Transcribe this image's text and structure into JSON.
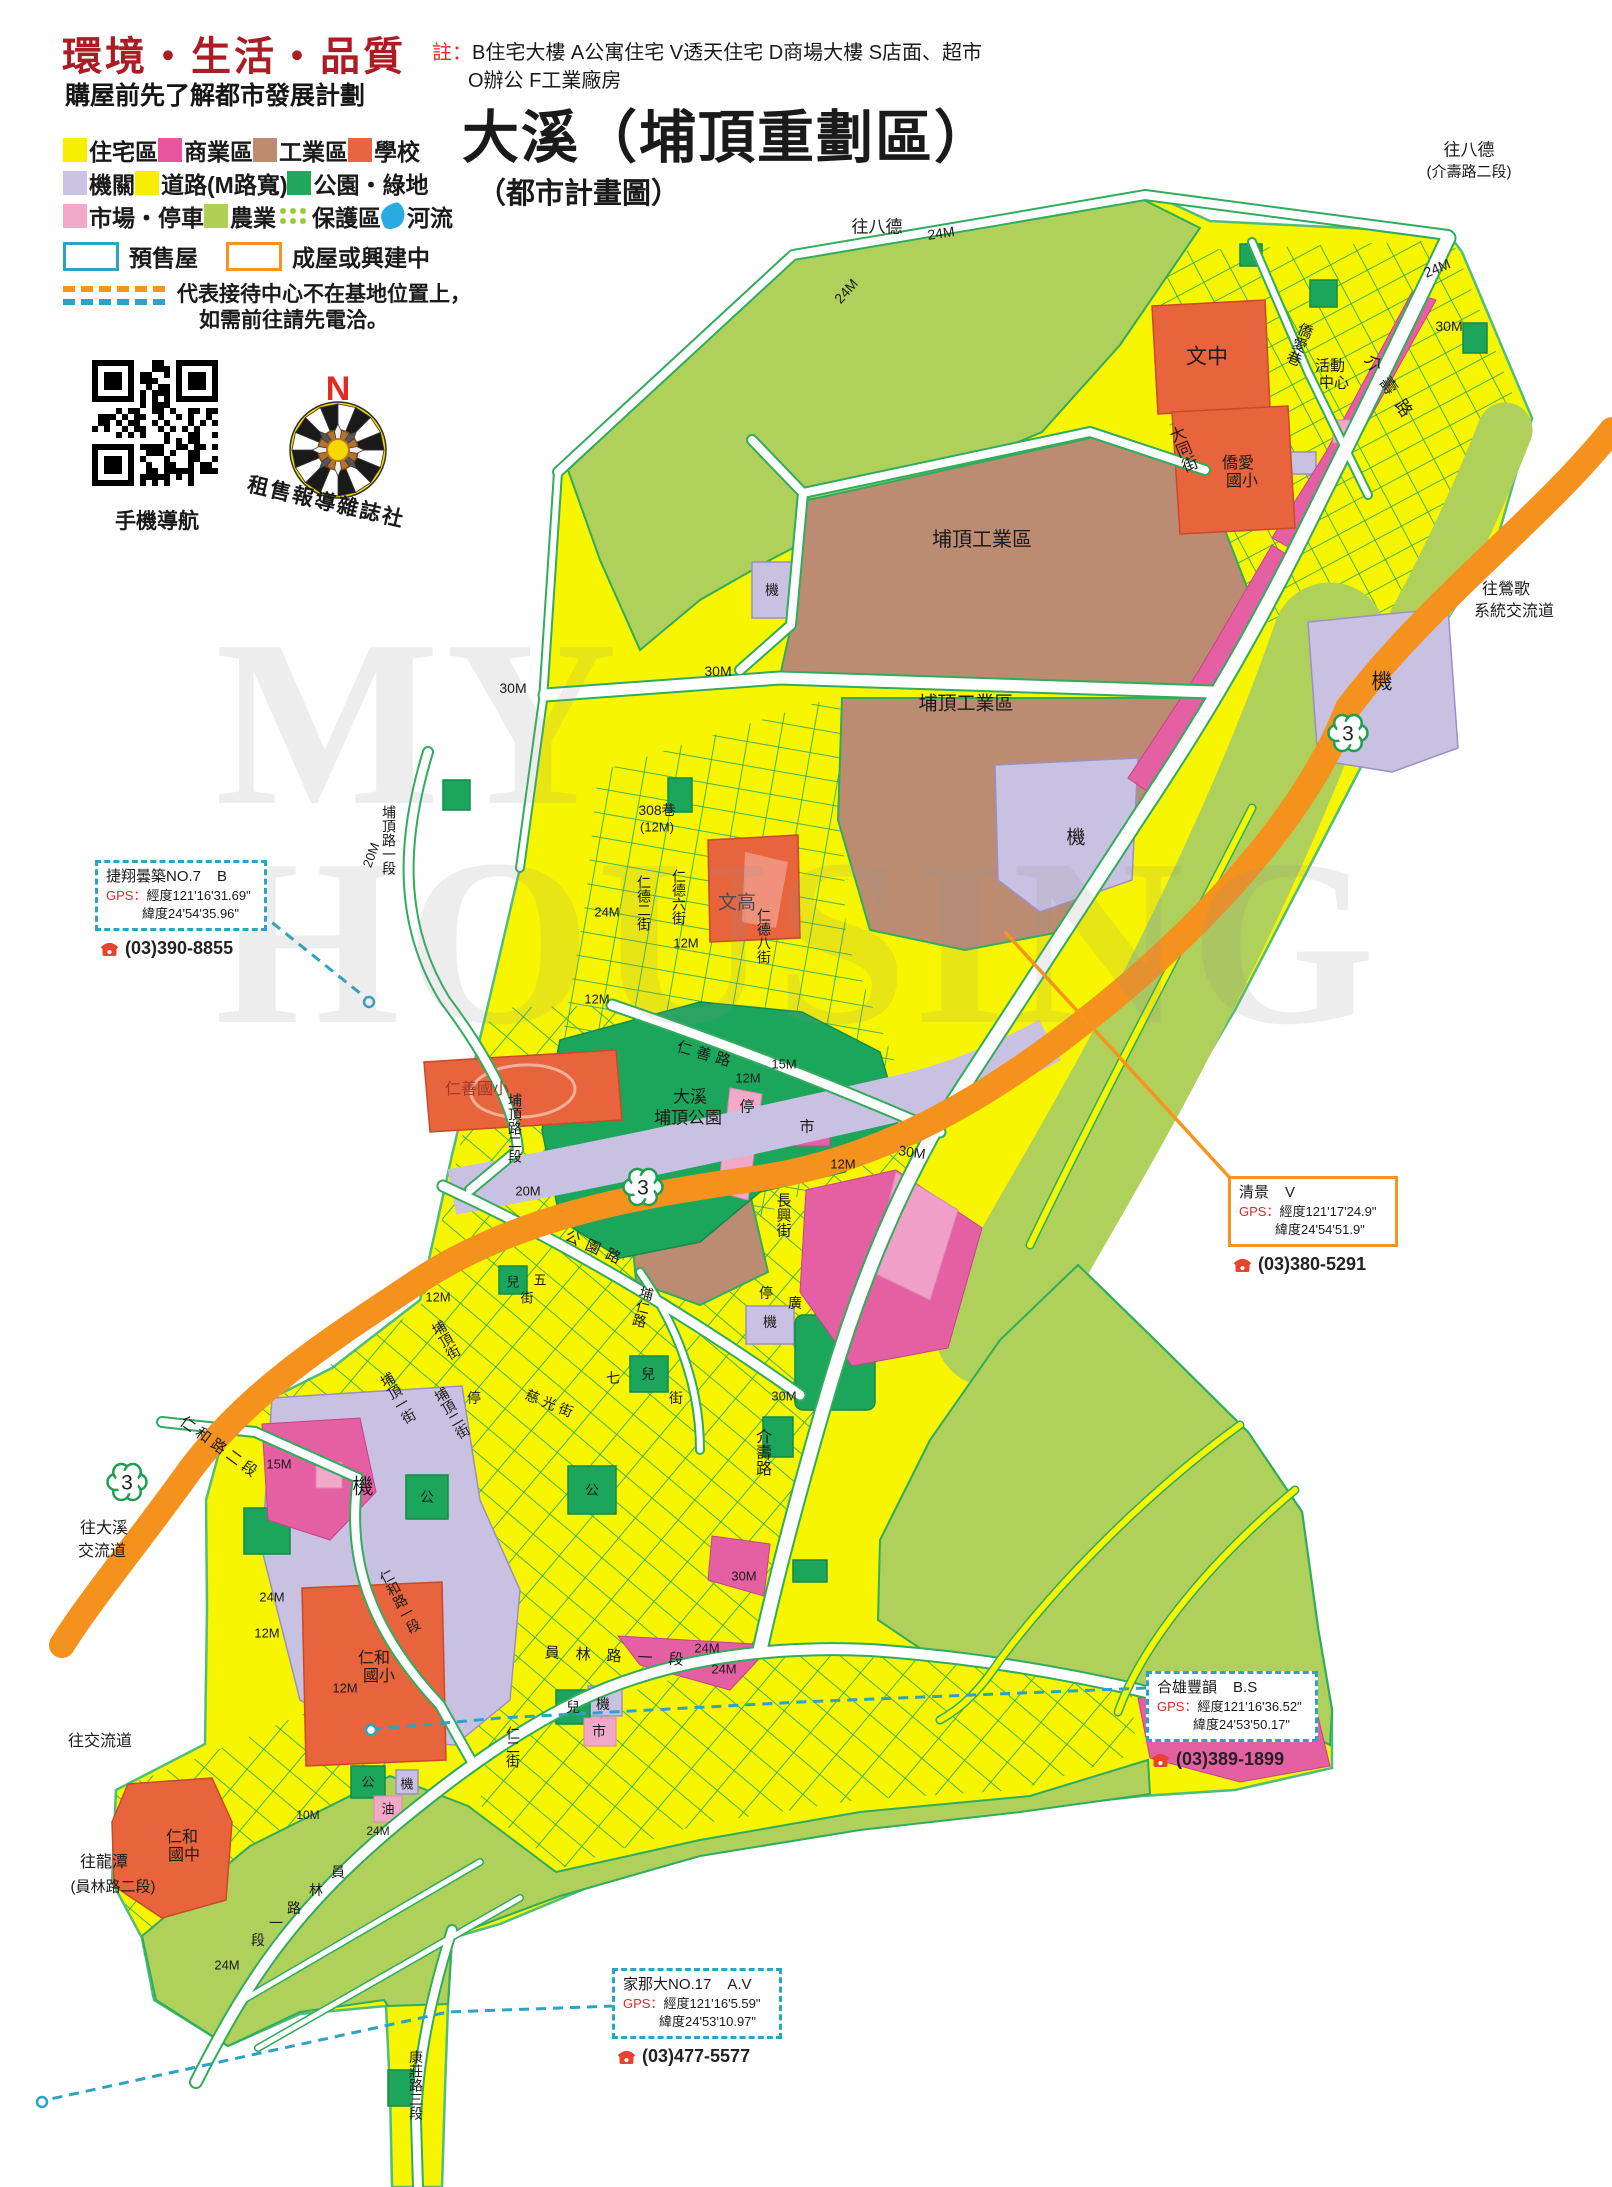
{
  "header": {
    "slogan": "環境・生活・品質",
    "subtitle": "購屋前先了解都市發展計劃",
    "note_label": "註：",
    "note_line1": "B住宅大樓 A公寓住宅 V透天住宅 D商場大樓 S店面、超市",
    "note_line2": "O辦公 F工業廠房",
    "title": "大溪（埔頂重劃區）",
    "title2": "（都市計畫圖）"
  },
  "legend": {
    "rows": [
      [
        {
          "label": "住宅區",
          "swatch": "yellow"
        },
        {
          "label": "商業區",
          "swatch": "magenta"
        },
        {
          "label": "工業區",
          "swatch": "brown"
        },
        {
          "label": "學校",
          "swatch": "orange"
        }
      ],
      [
        {
          "label": "機關",
          "swatch": "lavender"
        },
        {
          "label": "道路(M路寬)",
          "swatch": "yellow"
        },
        {
          "label": "公園・綠地",
          "swatch": "green"
        }
      ],
      [
        {
          "label": "市場・停車",
          "swatch": "lightpink"
        },
        {
          "label": "農業",
          "swatch": "lightgreen"
        },
        {
          "label": "保護區",
          "swatch": "dots"
        },
        {
          "label": "河流",
          "swatch": "river"
        }
      ]
    ],
    "presale": "預售屋",
    "built": "成屋或興建中",
    "dash_note1": "代表接待中心不在基地位置上，",
    "dash_note2": "如需前往請先電洽。"
  },
  "qr": {
    "caption": "手機導航"
  },
  "compass": {
    "north": "N",
    "brand": "租售報導雜誌社"
  },
  "watermark": {
    "line1": "MY",
    "line2": "HOUSING"
  },
  "colors": {
    "residential": "#F7F500",
    "commercial": "#E560A2",
    "industrial": "#BC8C72",
    "school": "#E8643C",
    "institution": "#C9C1E2",
    "park": "#1CA65C",
    "market": "#F2A9C9",
    "agriculture": "#AFD05A",
    "river": "#29ABE2",
    "presale_border": "#2AA3C6",
    "built_border": "#F7941E",
    "highway": "#F5921E",
    "road_outline": "#2FAC5C"
  },
  "route_markers": {
    "label": "3",
    "points": [
      {
        "x": 1348,
        "y": 733
      },
      {
        "x": 643,
        "y": 1187
      },
      {
        "x": 127,
        "y": 1482
      }
    ]
  },
  "callouts": [
    {
      "name": "捷翔曇築NO.7",
      "type": "B",
      "gps_label": "GPS：",
      "gps_lng": "經度121'16'31.69\"",
      "gps_lat": "緯度24'54'35.96\"",
      "phone": "(03)390-8855",
      "style": "dashed",
      "x": 95,
      "y": 860,
      "w": 150
    },
    {
      "name": "清景",
      "type": "V",
      "gps_label": "GPS：",
      "gps_lng": "經度121'17'24.9\"",
      "gps_lat": "緯度24'54'51.9\"",
      "phone": "(03)380-5291",
      "style": "solid",
      "x": 1228,
      "y": 1176,
      "w": 148
    },
    {
      "name": "合雄豐韻",
      "type": "B.S",
      "gps_label": "GPS：",
      "gps_lng": "經度121'16'36.52\"",
      "gps_lat": "緯度24'53'50.17\"",
      "phone": "(03)389-1899",
      "style": "dashed",
      "x": 1146,
      "y": 1671,
      "w": 150
    },
    {
      "name": "家那大NO.17",
      "type": "A.V",
      "gps_label": "GPS：",
      "gps_lng": "經度121'16'5.59\"",
      "gps_lat": "緯度24'53'10.97\"",
      "phone": "(03)477-5577",
      "style": "dashed",
      "x": 612,
      "y": 1968,
      "w": 148
    }
  ],
  "map_labels": [
    {
      "t": "往八德",
      "x": 877,
      "y": 227,
      "s": 17
    },
    {
      "t": "24M",
      "x": 941,
      "y": 233,
      "s": 14,
      "r": -8
    },
    {
      "t": "24M",
      "x": 846,
      "y": 291,
      "s": 14,
      "r": -48
    },
    {
      "t": "往八德",
      "x": 1469,
      "y": 150,
      "s": 17
    },
    {
      "t": "(介壽路二段)",
      "x": 1469,
      "y": 172,
      "s": 15
    },
    {
      "t": "24M",
      "x": 1437,
      "y": 268,
      "s": 14,
      "r": -22
    },
    {
      "t": "30M",
      "x": 1449,
      "y": 326,
      "s": 14
    },
    {
      "t": "僑愛巷",
      "x": 1299,
      "y": 344,
      "s": 15,
      "v": 1,
      "r": 22
    },
    {
      "t": "活動",
      "x": 1330,
      "y": 366,
      "s": 15
    },
    {
      "t": "中心",
      "x": 1334,
      "y": 383,
      "s": 15
    },
    {
      "t": "文中",
      "x": 1207,
      "y": 357,
      "s": 21
    },
    {
      "t": "大同街",
      "x": 1181,
      "y": 450,
      "s": 16,
      "v": 1,
      "r": -22
    },
    {
      "t": "僑愛",
      "x": 1238,
      "y": 464,
      "s": 16
    },
    {
      "t": "國小",
      "x": 1242,
      "y": 482,
      "s": 16
    },
    {
      "t": "介壽路",
      "x": 1391,
      "y": 390,
      "s": 17,
      "r": 56,
      "ls": 10
    },
    {
      "t": "往鶯歌",
      "x": 1506,
      "y": 590,
      "s": 16
    },
    {
      "t": "系統交流道",
      "x": 1514,
      "y": 612,
      "s": 16
    },
    {
      "t": "埔頂工業區",
      "x": 982,
      "y": 540,
      "s": 20
    },
    {
      "t": "埔頂工業區",
      "x": 966,
      "y": 704,
      "s": 19
    },
    {
      "t": "30M",
      "x": 513,
      "y": 688,
      "s": 14
    },
    {
      "t": "30M",
      "x": 718,
      "y": 671,
      "s": 14
    },
    {
      "t": "機",
      "x": 1382,
      "y": 682,
      "s": 21
    },
    {
      "t": "機",
      "x": 1076,
      "y": 838,
      "s": 19
    },
    {
      "t": "機",
      "x": 772,
      "y": 590,
      "s": 14
    },
    {
      "t": "308巷",
      "x": 657,
      "y": 810,
      "s": 14
    },
    {
      "t": "(12M)",
      "x": 657,
      "y": 827,
      "s": 13
    },
    {
      "t": "24M",
      "x": 607,
      "y": 912,
      "s": 13
    },
    {
      "t": "仁德二街",
      "x": 644,
      "y": 903,
      "s": 14,
      "v": 1
    },
    {
      "t": "仁德六街",
      "x": 679,
      "y": 897,
      "s": 14,
      "v": 1
    },
    {
      "t": "文高",
      "x": 737,
      "y": 903,
      "s": 19,
      "c": "#4d4d4d"
    },
    {
      "t": "仁德八街",
      "x": 764,
      "y": 936,
      "s": 14,
      "v": 1
    },
    {
      "t": "12M",
      "x": 686,
      "y": 943,
      "s": 13
    },
    {
      "t": "12M",
      "x": 597,
      "y": 999,
      "s": 13
    },
    {
      "t": "仁善路",
      "x": 706,
      "y": 1055,
      "s": 15,
      "r": 16,
      "ls": 5
    },
    {
      "t": "12M",
      "x": 748,
      "y": 1078,
      "s": 13
    },
    {
      "t": "15M",
      "x": 784,
      "y": 1064,
      "s": 13
    },
    {
      "t": "仁善國小",
      "x": 477,
      "y": 1090,
      "s": 16,
      "c": "#9c3a28"
    },
    {
      "t": "埔頂路一段",
      "x": 389,
      "y": 840,
      "s": 14,
      "v": 1
    },
    {
      "t": "20M",
      "x": 371,
      "y": 855,
      "s": 13,
      "r": -70
    },
    {
      "t": "大溪",
      "x": 690,
      "y": 1097,
      "s": 17
    },
    {
      "t": "埔頂公園",
      "x": 688,
      "y": 1118,
      "s": 17
    },
    {
      "t": "停",
      "x": 747,
      "y": 1107,
      "s": 15
    },
    {
      "t": "市",
      "x": 807,
      "y": 1127,
      "s": 15
    },
    {
      "t": "30M",
      "x": 912,
      "y": 1152,
      "s": 14,
      "r": 8
    },
    {
      "t": "12M",
      "x": 843,
      "y": 1164,
      "s": 13
    },
    {
      "t": "長興街",
      "x": 783,
      "y": 1215,
      "s": 15,
      "v": 1
    },
    {
      "t": "埔頂路二段",
      "x": 515,
      "y": 1128,
      "s": 14,
      "v": 1
    },
    {
      "t": "20M",
      "x": 528,
      "y": 1191,
      "s": 13
    },
    {
      "t": "公園路",
      "x": 596,
      "y": 1249,
      "s": 15,
      "r": 24,
      "ls": 7
    },
    {
      "t": "埔仁路",
      "x": 643,
      "y": 1307,
      "s": 14,
      "v": 1,
      "r": 14
    },
    {
      "t": "兒",
      "x": 513,
      "y": 1282,
      "s": 13
    },
    {
      "t": "五",
      "x": 540,
      "y": 1280,
      "s": 13
    },
    {
      "t": "街",
      "x": 527,
      "y": 1298,
      "s": 13
    },
    {
      "t": "12M",
      "x": 438,
      "y": 1297,
      "s": 13
    },
    {
      "t": "埔頂街",
      "x": 446,
      "y": 1340,
      "s": 14,
      "v": 1,
      "r": -30
    },
    {
      "t": "埔頂一街",
      "x": 398,
      "y": 1398,
      "s": 14,
      "v": 1,
      "r": -30
    },
    {
      "t": "埔頂二街",
      "x": 452,
      "y": 1413,
      "s": 14,
      "v": 1,
      "r": -30
    },
    {
      "t": "停",
      "x": 474,
      "y": 1398,
      "s": 14
    },
    {
      "t": "兒",
      "x": 648,
      "y": 1374,
      "s": 14
    },
    {
      "t": "七",
      "x": 613,
      "y": 1378,
      "s": 14
    },
    {
      "t": "街",
      "x": 676,
      "y": 1398,
      "s": 14
    },
    {
      "t": "慈光街",
      "x": 551,
      "y": 1404,
      "s": 14,
      "r": 22,
      "ls": 4
    },
    {
      "t": "公",
      "x": 592,
      "y": 1490,
      "s": 14
    },
    {
      "t": "仁和路二段",
      "x": 220,
      "y": 1448,
      "s": 15,
      "r": 36,
      "ls": 4
    },
    {
      "t": "15M",
      "x": 279,
      "y": 1464,
      "s": 13
    },
    {
      "t": "機",
      "x": 363,
      "y": 1487,
      "s": 21
    },
    {
      "t": "公",
      "x": 427,
      "y": 1497,
      "s": 14
    },
    {
      "t": "仁和路一段",
      "x": 400,
      "y": 1601,
      "s": 14,
      "v": 1,
      "r": -28
    },
    {
      "t": "12M",
      "x": 345,
      "y": 1688,
      "s": 13
    },
    {
      "t": "24M",
      "x": 272,
      "y": 1597,
      "s": 13
    },
    {
      "t": "12M",
      "x": 267,
      "y": 1633,
      "s": 13
    },
    {
      "t": "仁和",
      "x": 374,
      "y": 1659,
      "s": 16
    },
    {
      "t": "國小",
      "x": 379,
      "y": 1677,
      "s": 16
    },
    {
      "t": "兒",
      "x": 573,
      "y": 1707,
      "s": 14
    },
    {
      "t": "機",
      "x": 603,
      "y": 1704,
      "s": 14
    },
    {
      "t": "市",
      "x": 599,
      "y": 1731,
      "s": 14
    },
    {
      "t": "仁二街",
      "x": 513,
      "y": 1747,
      "s": 14,
      "v": 1
    },
    {
      "t": "員林路一段",
      "x": 622,
      "y": 1657,
      "s": 15,
      "r": 3,
      "ls": 16
    },
    {
      "t": "24M",
      "x": 707,
      "y": 1648,
      "s": 13
    },
    {
      "t": "24M",
      "x": 724,
      "y": 1669,
      "s": 13
    },
    {
      "t": "公",
      "x": 368,
      "y": 1782,
      "s": 13
    },
    {
      "t": "機",
      "x": 407,
      "y": 1784,
      "s": 13
    },
    {
      "t": "油",
      "x": 388,
      "y": 1809,
      "s": 13
    },
    {
      "t": "10M",
      "x": 308,
      "y": 1815,
      "s": 12
    },
    {
      "t": "24M",
      "x": 378,
      "y": 1831,
      "s": 12
    },
    {
      "t": "仁和",
      "x": 182,
      "y": 1838,
      "s": 16
    },
    {
      "t": "國中",
      "x": 184,
      "y": 1856,
      "s": 16
    },
    {
      "t": "員",
      "x": 338,
      "y": 1872,
      "s": 14
    },
    {
      "t": "林",
      "x": 316,
      "y": 1890,
      "s": 14
    },
    {
      "t": "路",
      "x": 294,
      "y": 1908,
      "s": 14
    },
    {
      "t": "一",
      "x": 276,
      "y": 1923,
      "s": 14
    },
    {
      "t": "段",
      "x": 258,
      "y": 1940,
      "s": 14
    },
    {
      "t": "24M",
      "x": 227,
      "y": 1965,
      "s": 13
    },
    {
      "t": "往交流道",
      "x": 100,
      "y": 1742,
      "s": 16
    },
    {
      "t": "往大溪",
      "x": 104,
      "y": 1529,
      "s": 16
    },
    {
      "t": "交流道",
      "x": 102,
      "y": 1552,
      "s": 16
    },
    {
      "t": "往龍潭",
      "x": 104,
      "y": 1863,
      "s": 16
    },
    {
      "t": "(員林路二段)",
      "x": 113,
      "y": 1887,
      "s": 15
    },
    {
      "t": "康莊路三段",
      "x": 416,
      "y": 2085,
      "s": 14,
      "v": 1
    },
    {
      "t": "停",
      "x": 766,
      "y": 1293,
      "s": 14
    },
    {
      "t": "廣",
      "x": 795,
      "y": 1303,
      "s": 14
    },
    {
      "t": "機",
      "x": 770,
      "y": 1322,
      "s": 14
    },
    {
      "t": "介壽路",
      "x": 761,
      "y": 1452,
      "s": 16,
      "v": 1
    },
    {
      "t": "30M",
      "x": 784,
      "y": 1396,
      "s": 13
    },
    {
      "t": "30M",
      "x": 744,
      "y": 1576,
      "s": 13
    }
  ]
}
